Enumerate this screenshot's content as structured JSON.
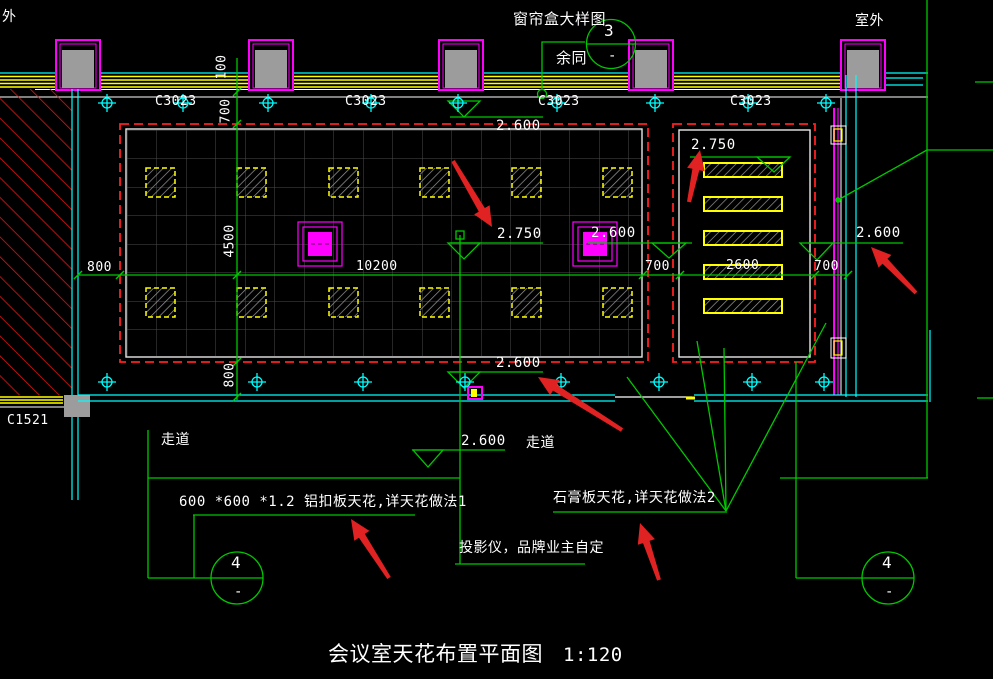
{
  "labels": {
    "outdoor_left": "外",
    "outdoor_right": "室外",
    "corridor_left": "走道",
    "corridor_right": "走道",
    "door_left": "C1521"
  },
  "detail_callout_top": {
    "title": "窗帘盒大样图",
    "note": "余同",
    "number": "3",
    "sheet": "-"
  },
  "section_callouts": {
    "left": {
      "number": "4",
      "sheet": "-"
    },
    "right": {
      "number": "4",
      "sheet": "-"
    }
  },
  "windows": {
    "labels": [
      "C3023",
      "C3023",
      "C3023",
      "C3023"
    ]
  },
  "dimensions": {
    "left_vertical": [
      "100",
      "700",
      "4500",
      "800"
    ],
    "bottom_horizontal": [
      "800",
      "10200",
      "700",
      "2600",
      "700"
    ]
  },
  "elevations": {
    "top_center": "2.600",
    "center": "2.750",
    "at_fixture": "2.600",
    "right_wall": "2.600",
    "right_room": "2.750",
    "main_bottom": "2.600",
    "corridor": "2.600"
  },
  "notes": {
    "aluminum_ceiling": "600 *600 *1.2 铝扣板天花,详天花做法1",
    "gypsum_ceiling": "石膏板天花,详天花做法2",
    "projector": "投影仪，品牌业主自定"
  },
  "title": {
    "text": "会议室天花布置平面图",
    "scale": "1:120"
  },
  "colors": {
    "green": "#00c800",
    "yellow": "#ffff00",
    "cyan": "#00ffff",
    "magenta": "#ff00ff",
    "red_dash": "#ff1f1f",
    "arrow_red": "#e02222",
    "white": "#ffffff",
    "grid_gray": "#4d4d4d",
    "column_gray": "#9c9c9c"
  }
}
